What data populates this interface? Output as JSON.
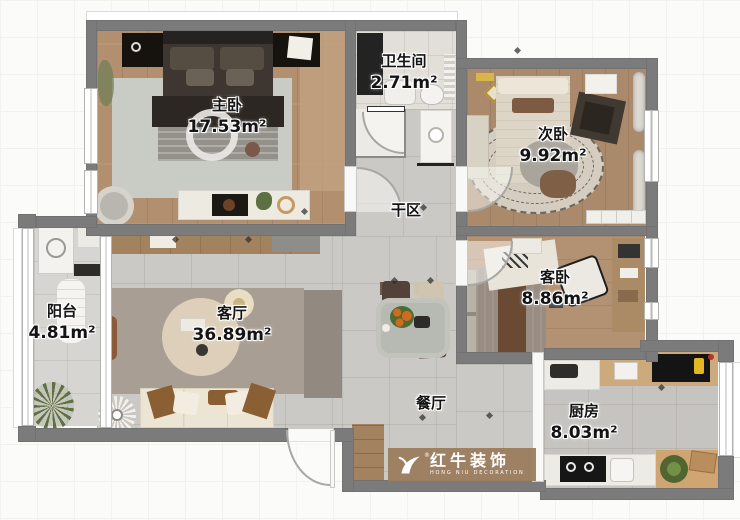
{
  "rooms": [
    {
      "id": "master-bedroom",
      "name": "主卧",
      "area": "17.53m²"
    },
    {
      "id": "bathroom",
      "name": "卫生间",
      "area": "2.71m²"
    },
    {
      "id": "second-bedroom",
      "name": "次卧",
      "area": "9.92m²"
    },
    {
      "id": "dry-area",
      "name": "干区",
      "area": ""
    },
    {
      "id": "living-room",
      "name": "客厅",
      "area": "36.89m²"
    },
    {
      "id": "balcony",
      "name": "阳台",
      "area": "4.81m²"
    },
    {
      "id": "guest-bedroom",
      "name": "客卧",
      "area": "8.86m²"
    },
    {
      "id": "dining-room",
      "name": "餐厅",
      "area": ""
    },
    {
      "id": "kitchen",
      "name": "厨房",
      "area": "8.03m²"
    }
  ],
  "watermark": {
    "brand": "红牛装饰",
    "subtitle": "HONG NIU DECORATION",
    "registered_mark": "®",
    "logo_icon": "bull-icon"
  },
  "colors": {
    "wall": "#7b7b7b",
    "wood_floor": "#b2906f",
    "tile_gray": "#cbc9c5",
    "tile_light": "#d7d5d1",
    "bath_tile": "#e2dfd9",
    "accent_wood": "#a3825f",
    "watermark_band": "#9b7d5e"
  }
}
